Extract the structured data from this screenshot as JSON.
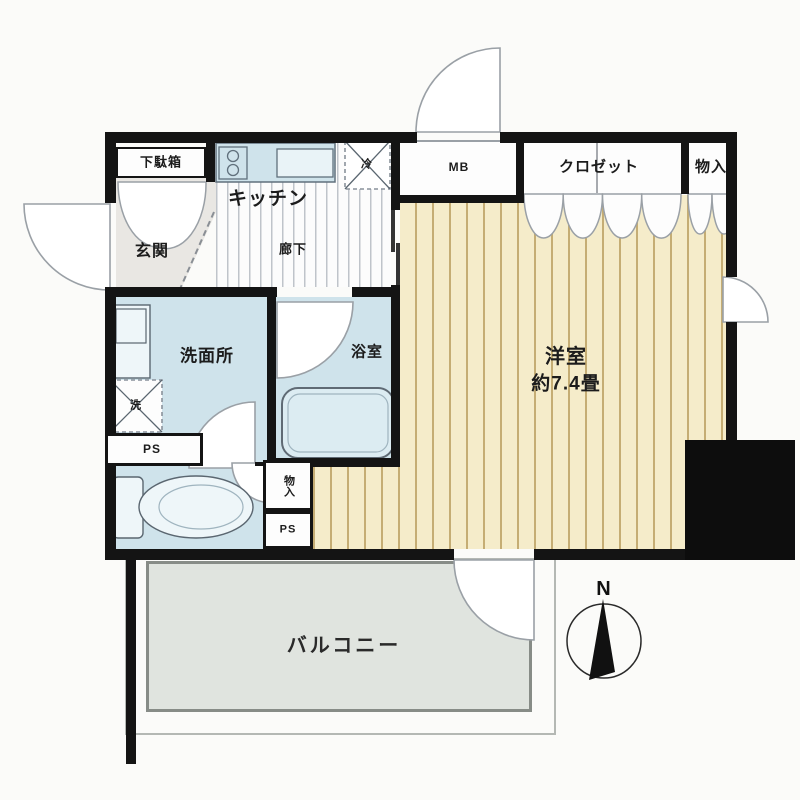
{
  "plan": {
    "type": "apartment-floor-plan",
    "compass_label": "N",
    "rooms": {
      "shoe_cabinet": "下駄箱",
      "genkan": "玄関",
      "kitchen": "キッチン",
      "hallway": "廊下",
      "meter_box": "MB",
      "closet": "クロゼット",
      "storage_top": "物入",
      "washroom": "洗面所",
      "bathroom": "浴室",
      "western_room": "洋室",
      "western_room_size": "約7.4畳",
      "storage_small": "物入",
      "pipe_space_upper": "PS",
      "pipe_space_lower": "PS",
      "balcony": "バルコニー",
      "washer_mark": "洗",
      "fridge_mark": "冷"
    },
    "colors": {
      "wall": "#141414",
      "wet_area_floor": "#cfe3eb",
      "western_room_floor": "#f5ecca",
      "western_room_stripe": "#c5ad74",
      "balcony_floor": "#e0e4df",
      "genkan_floor": "#e9e7e3",
      "fixture_fill": "#eef6f9"
    }
  }
}
